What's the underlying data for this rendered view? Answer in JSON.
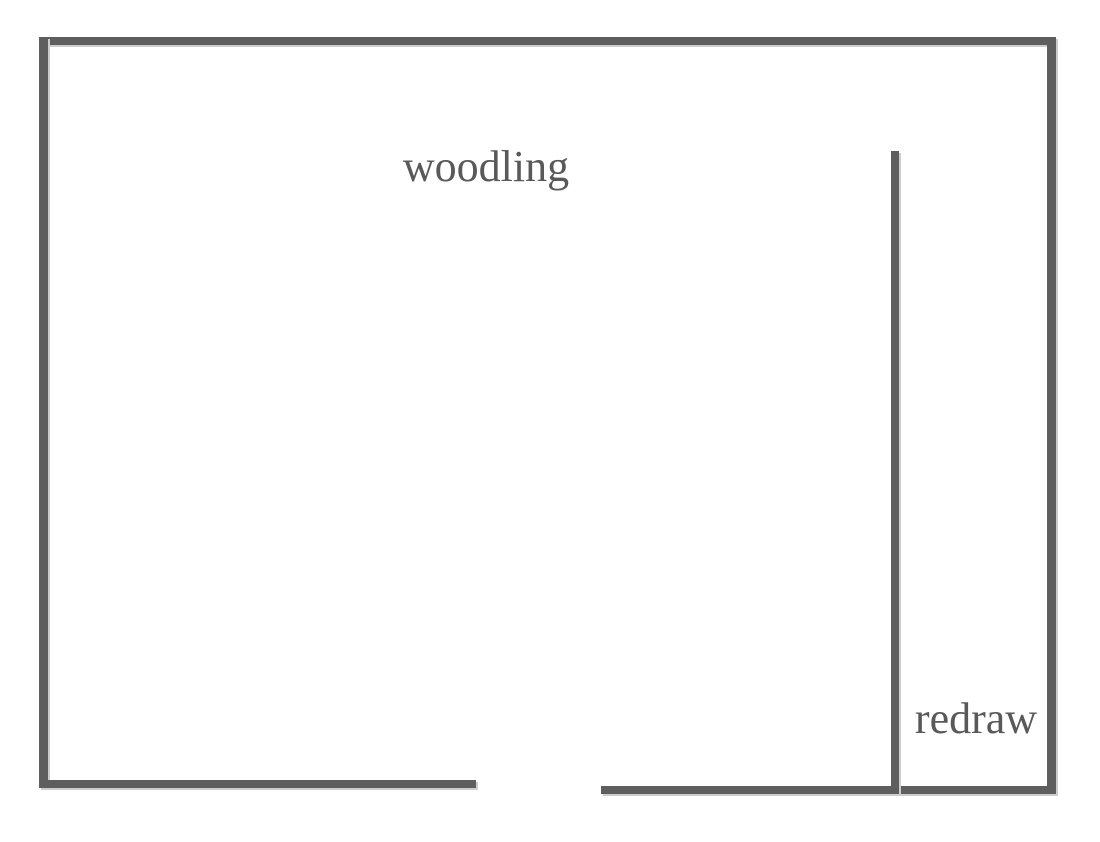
{
  "diagram": {
    "background": "#ffffff",
    "stroke_color": "#5e5e5e",
    "shadow_color": "#cdcdcd",
    "label_color": "#595959",
    "labels": {
      "woodling": {
        "text": "woodling",
        "cx": 486,
        "cy": 167
      },
      "redraw": {
        "text": "redraw",
        "cx": 976,
        "cy": 719
      }
    },
    "walls": [
      {
        "name": "outer-wall-top",
        "x": 39,
        "y": 37,
        "w": 1017,
        "h": 8
      },
      {
        "name": "outer-wall-left",
        "x": 39,
        "y": 37,
        "w": 9,
        "h": 751
      },
      {
        "name": "outer-wall-right",
        "x": 1047,
        "y": 37,
        "w": 9,
        "h": 757
      },
      {
        "name": "bottom-wall-left-segment",
        "x": 39,
        "y": 780,
        "w": 437,
        "h": 8
      },
      {
        "name": "bottom-wall-right-segment",
        "x": 601,
        "y": 786,
        "w": 455,
        "h": 8
      },
      {
        "name": "inner-partition-wall",
        "x": 891,
        "y": 151,
        "w": 8,
        "h": 643
      }
    ]
  }
}
